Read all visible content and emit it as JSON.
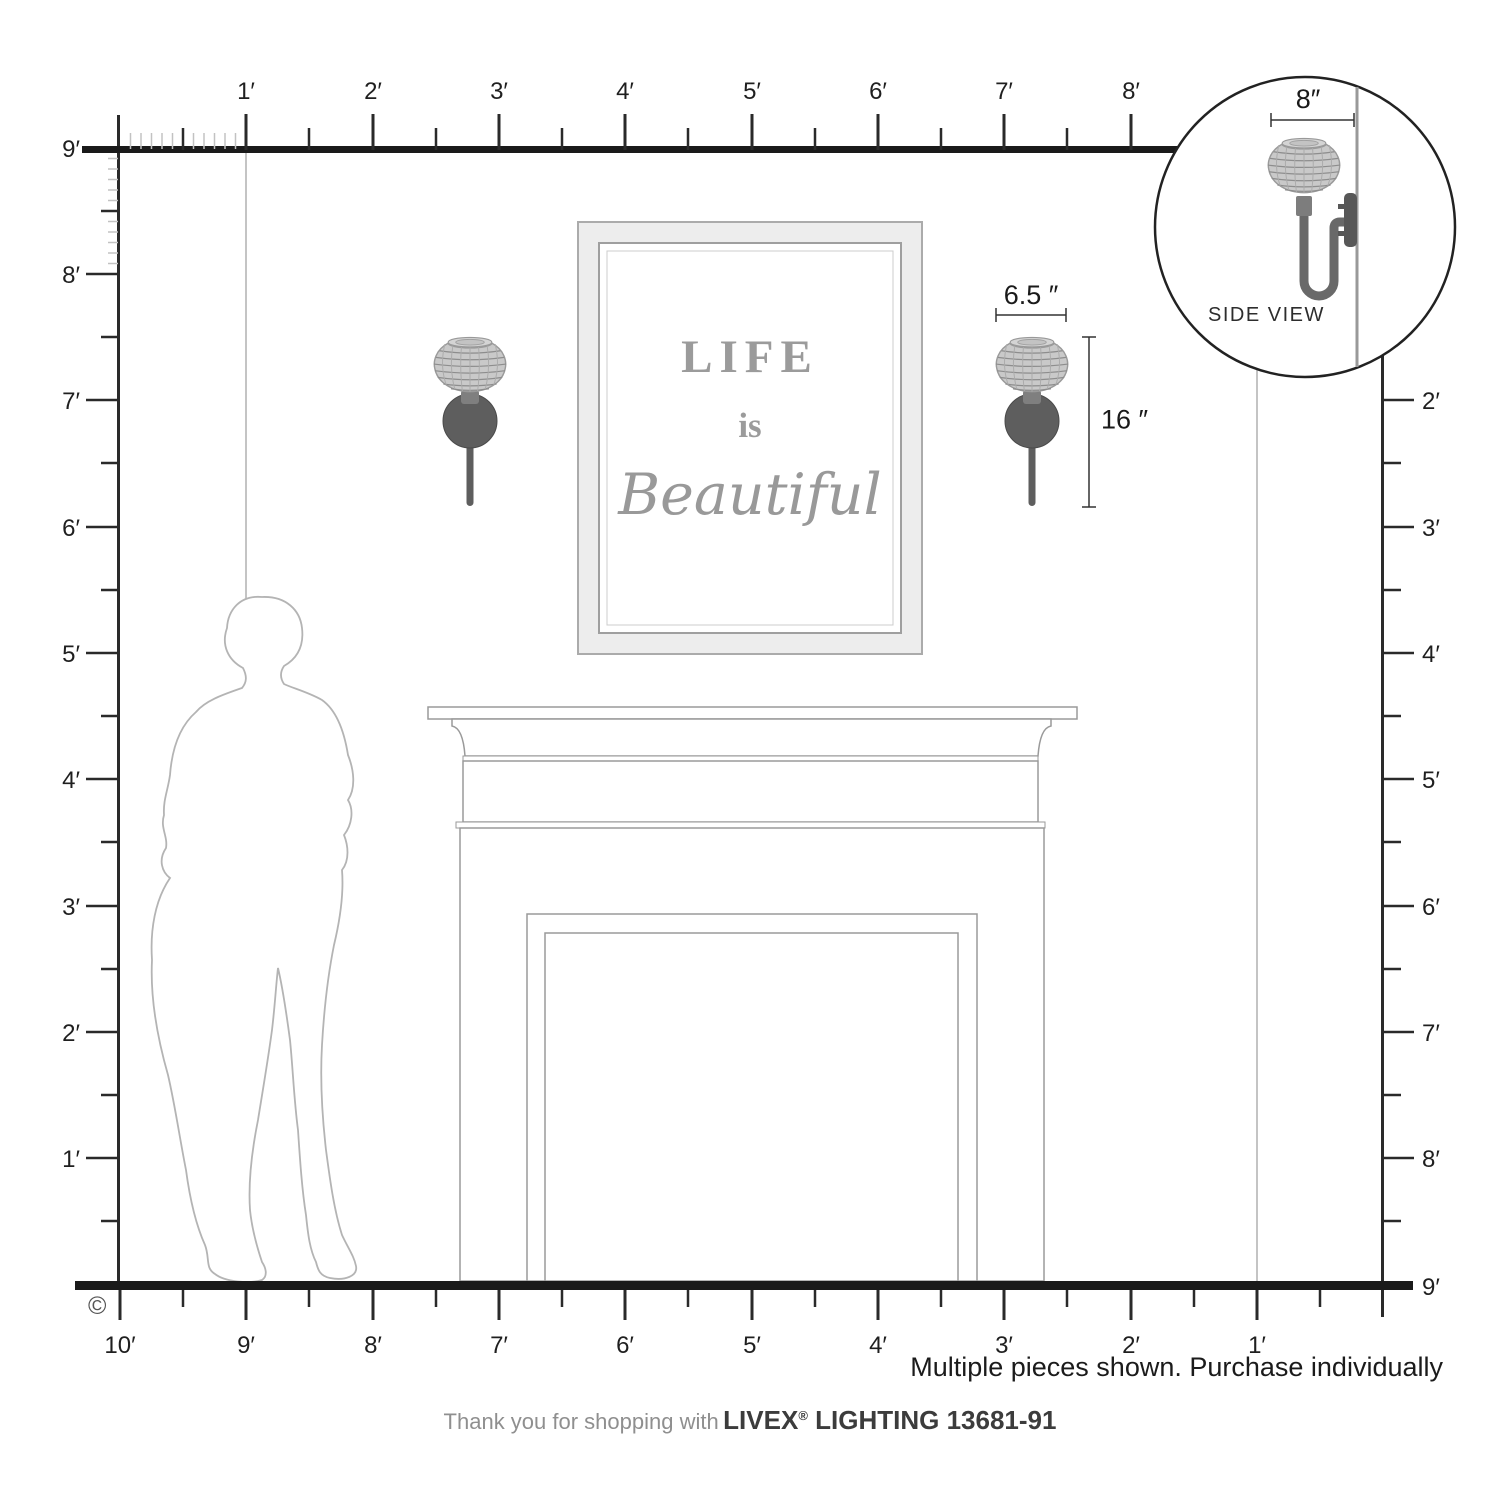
{
  "rulers": {
    "top": [
      "1′",
      "2′",
      "3′",
      "4′",
      "5′",
      "6′",
      "7′",
      "8′"
    ],
    "left": [
      "9′",
      "8′",
      "7′",
      "6′",
      "5′",
      "4′",
      "3′",
      "2′",
      "1′"
    ],
    "right": [
      "2′",
      "3′",
      "4′",
      "5′",
      "6′",
      "7′",
      "8′",
      "9′"
    ],
    "bottom": [
      "10′",
      "9′",
      "8′",
      "7′",
      "6′",
      "5′",
      "4′",
      "3′",
      "2′",
      "1′"
    ]
  },
  "artwork": {
    "line1": "LIFE",
    "line2": "is",
    "line3": "Beautiful"
  },
  "dimensions": {
    "width": "6.5 ″",
    "height": "16 ″",
    "depth": "8″"
  },
  "inset": {
    "label": "SIDE VIEW"
  },
  "notes": {
    "purchase": "Multiple pieces shown. Purchase individually",
    "copyright": "©"
  },
  "footer": {
    "prefix": "Thank you for shopping with",
    "brand": "LIVEX",
    "reg": "®",
    "suffix": " LIGHTING 13681-91"
  },
  "colors": {
    "line": "#1a1a1a",
    "ruler_fine": "#c2c2c2",
    "metal": "#5e5e5e",
    "shade": "#c9c9c9",
    "silhouette": "#b4b4b4",
    "art_text": "#9b9b9b"
  }
}
